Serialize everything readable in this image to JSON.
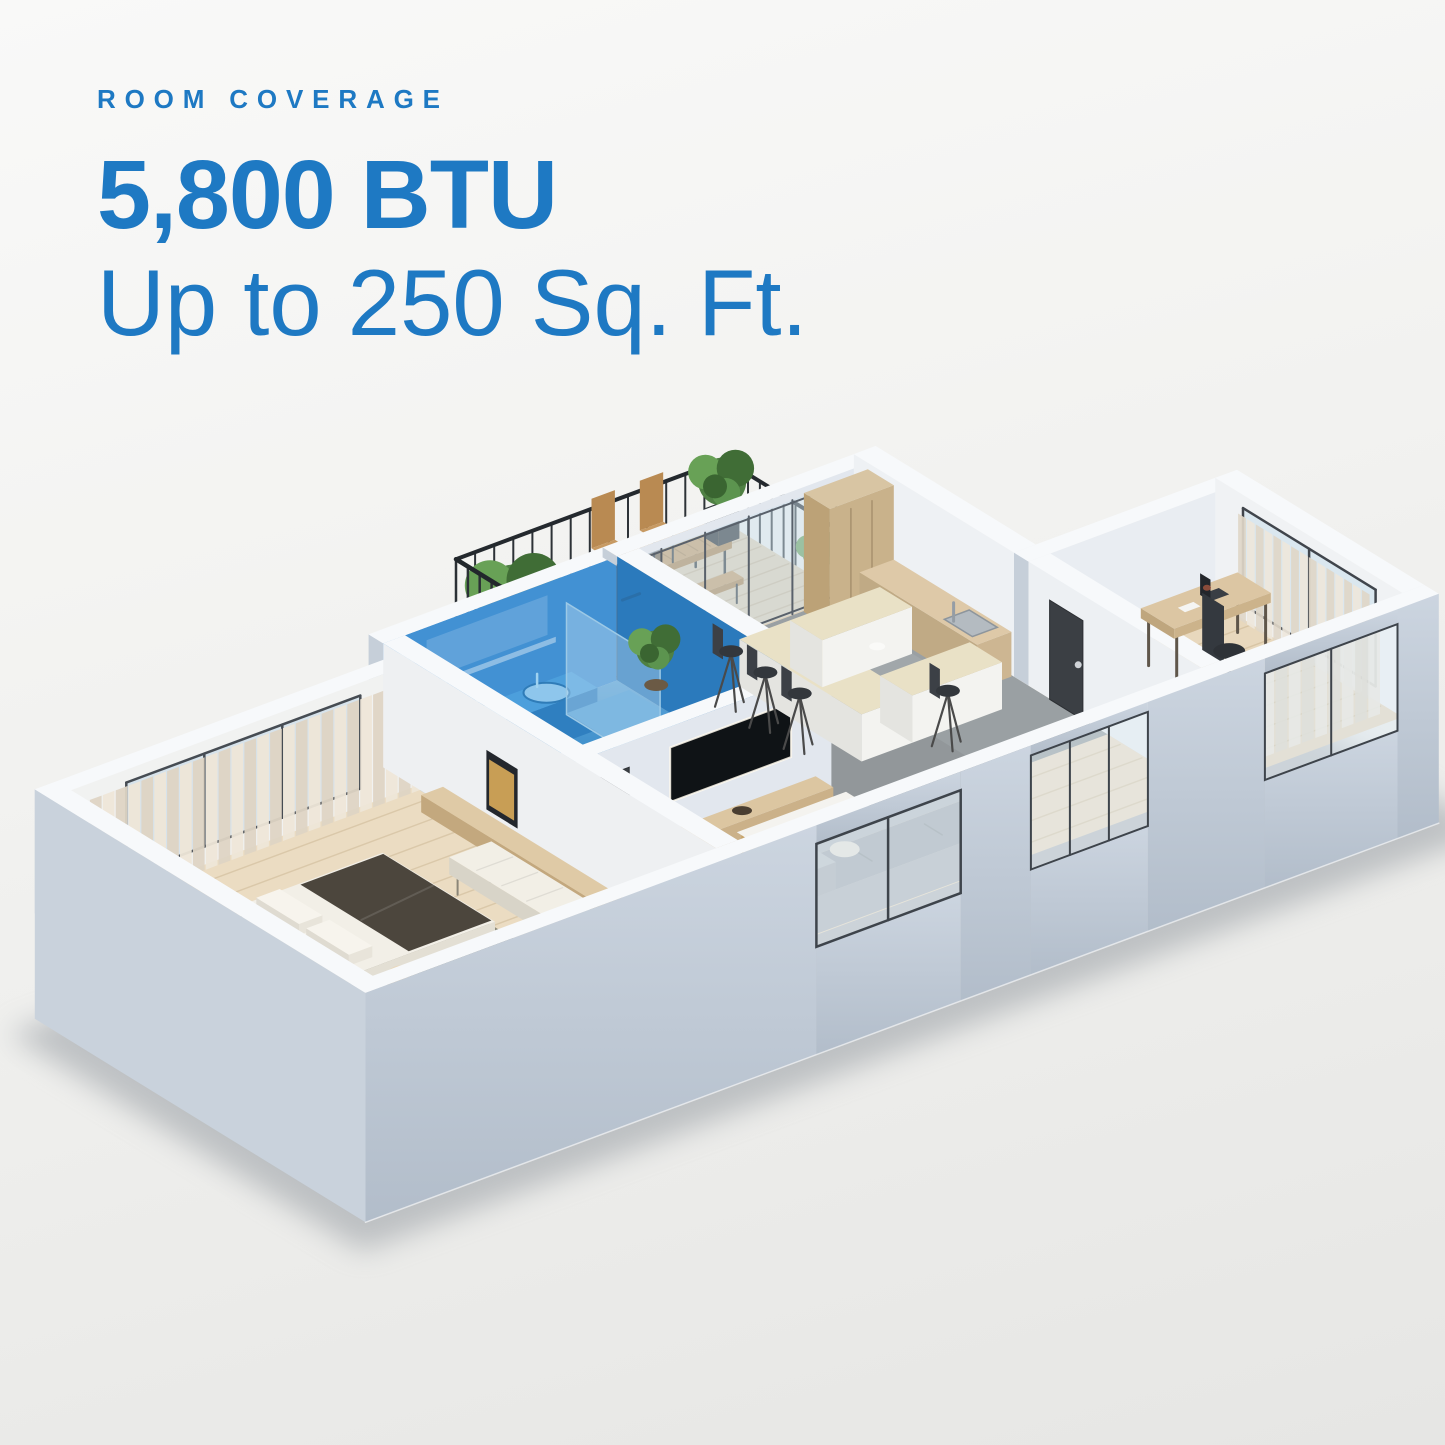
{
  "header": {
    "eyebrow": "ROOM COVERAGE",
    "spec_value": "5,800 BTU",
    "coverage_value": "Up to 250 Sq. Ft."
  },
  "colors": {
    "accent_blue": "#1E79C3",
    "highlight_room": "#2F87C8",
    "background_top": "#F9F9F8",
    "background_bottom": "#E6E6E4"
  },
  "floorplan": {
    "highlighted_room": "bathroom",
    "rooms": [
      "bedroom",
      "bathroom",
      "kitchen-dining",
      "living-area",
      "office",
      "balcony"
    ]
  }
}
